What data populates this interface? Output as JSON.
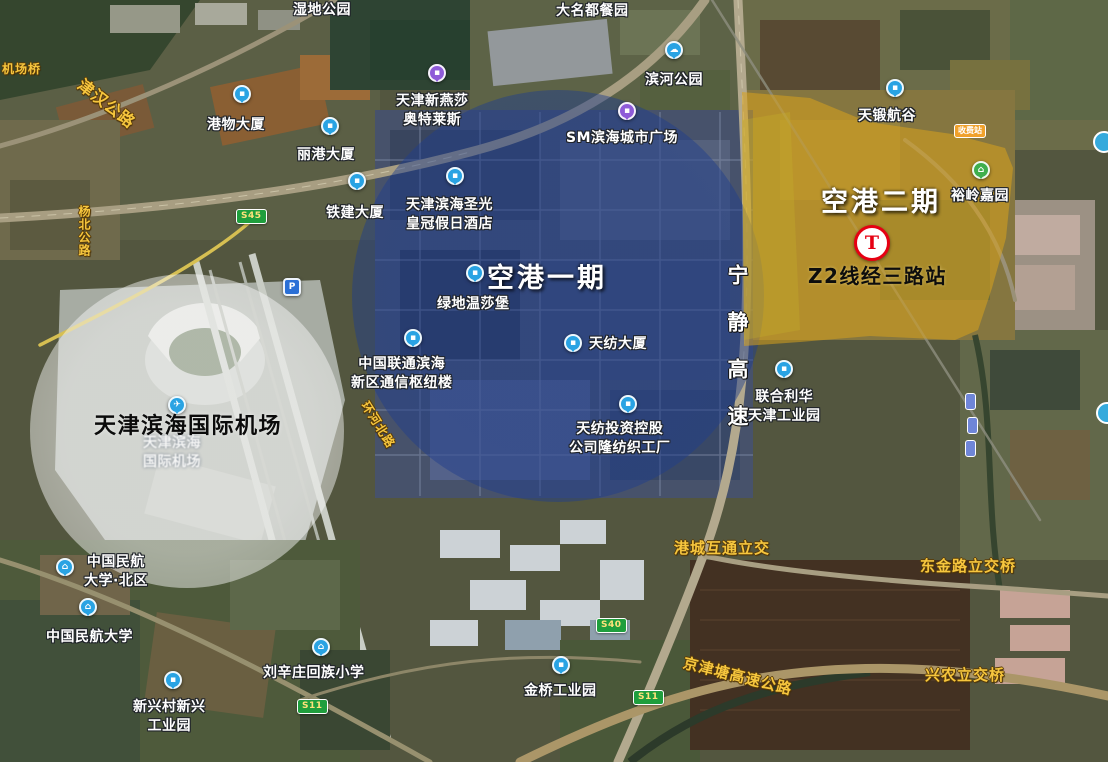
{
  "annotations": {
    "airport_circle": "天津滨海国际机场",
    "phase1": "空港一期",
    "phase2": "空港二期",
    "station": "Z2线经三路站",
    "ningjing_expressway": "宁静高速"
  },
  "colors": {
    "phase1_fill": "#1f3d8c",
    "phase2_fill": "#d9a31b",
    "airport_circle_fill": "#fafafa",
    "metro_red": "#e60012",
    "poi_pin_blue": "#29a3e3",
    "poi_pin_purple": "#8e5bd8",
    "poi_pin_green": "#3fae4d",
    "road_label_gold": "#f6c63e"
  },
  "pois": [
    {
      "name": "wetland-park",
      "text": "湿地公园"
    },
    {
      "name": "damingdu-restaurant",
      "text": "大名都餐园"
    },
    {
      "name": "gangwu-tower",
      "text": "港物大厦"
    },
    {
      "name": "ligang-tower",
      "text": "丽港大厦"
    },
    {
      "name": "tiejian-tower",
      "text": "铁建大厦"
    },
    {
      "name": "binhe-park",
      "text": "滨河公园"
    },
    {
      "name": "yansha-outlets",
      "text": "天津新燕莎\n奥特莱斯"
    },
    {
      "name": "sm-binhai-plaza",
      "text": "SM滨海城市广场"
    },
    {
      "name": "crowne-plaza-hotel",
      "text": "天津滨海圣光\n皇冠假日酒店"
    },
    {
      "name": "tianduan-valley",
      "text": "天锻航谷"
    },
    {
      "name": "yuling-jiayuan",
      "text": "裕岭嘉园"
    },
    {
      "name": "greenland-windsor",
      "text": "绿地温莎堡"
    },
    {
      "name": "china-unicom-hub",
      "text": "中国联通滨海\n新区通信枢纽楼"
    },
    {
      "name": "tianfang-tower",
      "text": "天纺大厦"
    },
    {
      "name": "textile-factory",
      "text": "天纺投资控股\n公司隆纺织工厂"
    },
    {
      "name": "unilever-industrial-park",
      "text": "联合利华\n天津工业园"
    },
    {
      "name": "cauc-north-campus",
      "text": "中国民航\n大学·北区"
    },
    {
      "name": "cauc",
      "text": "中国民航大学"
    },
    {
      "name": "liuxinzhuang-school",
      "text": "刘辛庄回族小学"
    },
    {
      "name": "xinxing-industrial",
      "text": "新兴村新兴\n工业园"
    },
    {
      "name": "jinqiao-industrial-park",
      "text": "金桥工业园"
    },
    {
      "name": "airport-basemap-label",
      "text": "天津滨海\n国际机场"
    }
  ],
  "roads": [
    {
      "name": "ningjing-expressway",
      "text": "宁静高速"
    },
    {
      "name": "gangcheng-interchange",
      "text": "港城互通立交"
    },
    {
      "name": "dongjin-interchange",
      "text": "东金路立交桥"
    },
    {
      "name": "xingnong-interchange",
      "text": "兴农立交桥"
    },
    {
      "name": "jingjintang-expressway",
      "text": "京津塘高速公路"
    },
    {
      "name": "jinhan-highway",
      "text": "津汉公路"
    },
    {
      "name": "jichang-bridge",
      "text": "机场桥"
    },
    {
      "name": "yangbei-highway",
      "text": "杨北公路"
    },
    {
      "name": "huanhebei-road",
      "text": "环河北路"
    }
  ],
  "shields": [
    {
      "text": "S45"
    },
    {
      "text": "S40"
    },
    {
      "text": "S11"
    },
    {
      "text": "S11"
    }
  ],
  "toll_badge": {
    "text": "收费站"
  },
  "icons": {
    "building": "▪",
    "park_cloud": "☁",
    "shopping": "▪",
    "hotel": "▪",
    "factory": "▪",
    "school": "⌂",
    "home": "⌂",
    "metro": "T",
    "parking": "P",
    "plane": "✈"
  }
}
